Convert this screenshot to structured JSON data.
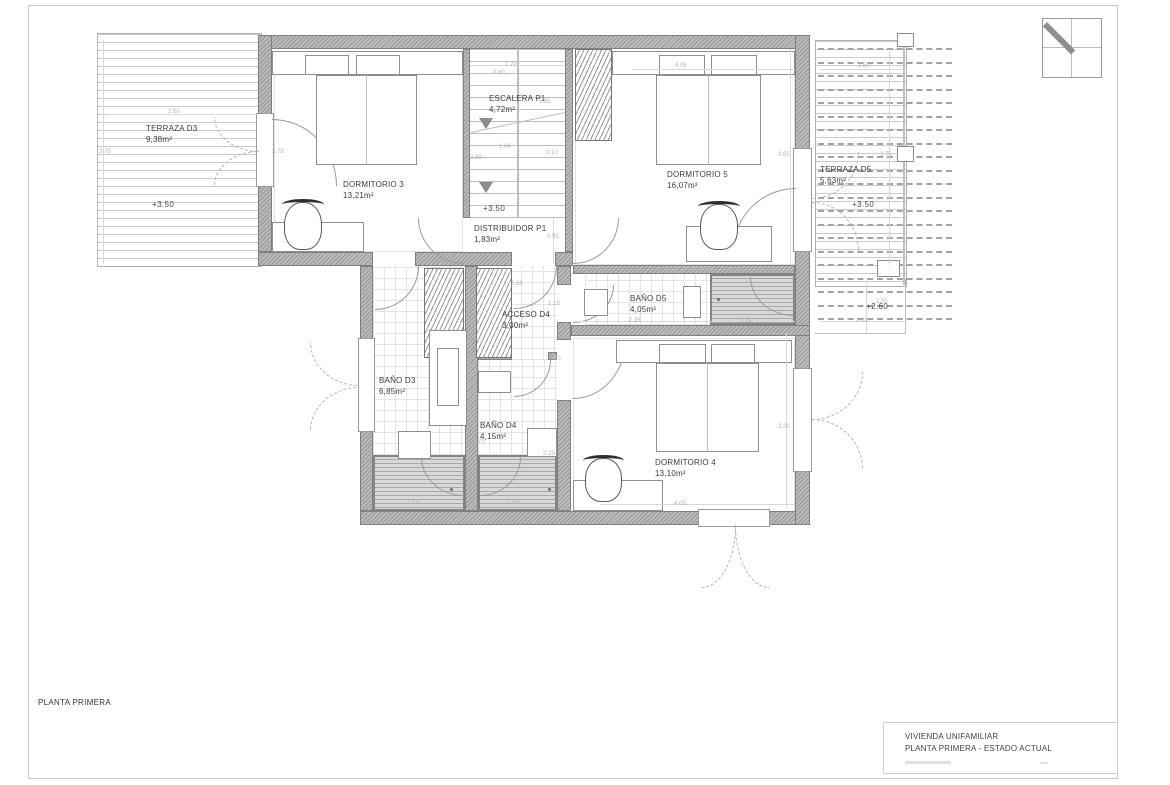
{
  "document": {
    "footer_label": "PLANTA PRIMERA",
    "title_block": {
      "project": "VIVIENDA UNIFAMILIAR",
      "sheet": "PLANTA PRIMERA  - ESTADO ACTUAL"
    }
  },
  "rooms": {
    "terraza_d3": {
      "name": "TERRAZA D3",
      "area": "9,38m²",
      "level": "+3.50"
    },
    "dormitorio_3": {
      "name": "DORMITORIO 3",
      "area": "13,21m²"
    },
    "escalera_p1": {
      "name": "ESCALERA P1",
      "area": "4,72m²",
      "level": "+3.50"
    },
    "distribuidor_p1": {
      "name": "DISTRIBUIDOR P1",
      "area": "1,83m²"
    },
    "dormitorio_5": {
      "name": "DORMITORIO 5",
      "area": "16,07m²"
    },
    "terraza_d5": {
      "name": "TERRAZA D5",
      "area": "5,63m²",
      "level": "+3.50",
      "level_lower": "+2.60"
    },
    "bano_d5": {
      "name": "BAÑO D5",
      "area": "4,05m²"
    },
    "acceso_d4": {
      "name": "ACCESO D4",
      "area": "3,00m²"
    },
    "bano_d3": {
      "name": "BAÑO D3",
      "area": "6,85m²"
    },
    "bano_d4": {
      "name": "BAÑO D4",
      "area": "4,15m²"
    },
    "dormitorio_4": {
      "name": "DORMITORIO 4",
      "area": "13,10m²"
    }
  },
  "dimensions": [
    {
      "text": "2.50",
      "x": 168,
      "y": 109
    },
    {
      "text": "3.75",
      "x": 99,
      "y": 149
    },
    {
      "text": "3.75",
      "x": 272,
      "y": 149
    },
    {
      "text": "1.70",
      "x": 505,
      "y": 62
    },
    {
      "text": "0.60",
      "x": 493,
      "y": 70
    },
    {
      "text": "0.30",
      "x": 539,
      "y": 99
    },
    {
      "text": "3.85",
      "x": 470,
      "y": 155
    },
    {
      "text": "1.84",
      "x": 499,
      "y": 144
    },
    {
      "text": "0.10",
      "x": 546,
      "y": 150
    },
    {
      "text": "4.05",
      "x": 675,
      "y": 63
    },
    {
      "text": "1.50",
      "x": 858,
      "y": 63
    },
    {
      "text": "3.65",
      "x": 778,
      "y": 152
    },
    {
      "text": "3.75",
      "x": 880,
      "y": 152
    },
    {
      "text": "0.95",
      "x": 547,
      "y": 234
    },
    {
      "text": "1.68",
      "x": 511,
      "y": 281
    },
    {
      "text": "1.15",
      "x": 548,
      "y": 301
    },
    {
      "text": "0.90",
      "x": 549,
      "y": 356
    },
    {
      "text": "2.35",
      "x": 629,
      "y": 318
    },
    {
      "text": "1.60",
      "x": 741,
      "y": 318
    },
    {
      "text": "2.70",
      "x": 473,
      "y": 439
    },
    {
      "text": "2.25",
      "x": 543,
      "y": 451
    },
    {
      "text": "1.88",
      "x": 407,
      "y": 500
    },
    {
      "text": "1.68",
      "x": 507,
      "y": 500
    },
    {
      "text": "3.20",
      "x": 778,
      "y": 424
    },
    {
      "text": "4.05",
      "x": 674,
      "y": 501
    },
    {
      "text": "1.80",
      "x": 856,
      "y": 318
    },
    {
      "text": "1.00",
      "x": 876,
      "y": 299
    }
  ]
}
